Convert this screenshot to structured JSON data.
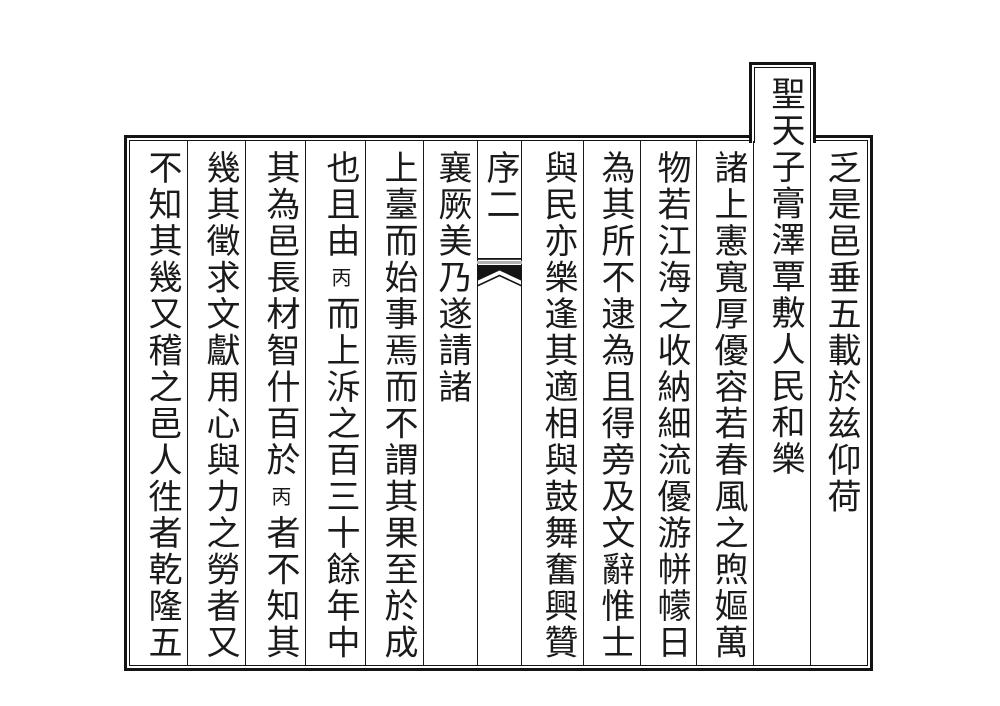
{
  "colors": {
    "ink": "#1a1a1a",
    "paper": "#ffffff",
    "ornament_gray": "#b0b0b0"
  },
  "reading_order": "columns right to left, characters top to bottom",
  "tab": {
    "label": "聖天子膏澤覃敷人民和樂"
  },
  "center_column": {
    "label": "序二",
    "ornament_icon": "fishtail-icon"
  },
  "columns": [
    {
      "text": "乏是邑垂五載於兹仰荷"
    },
    {
      "text": "聖天子膏澤覃敷人民和樂",
      "placement": "tab"
    },
    {
      "text": "諸上憲寬厚優容若春風之煦嫗萬"
    },
    {
      "text": "物若江海之收納細流優游帡幪日"
    },
    {
      "text": "為其所不逮為且得旁及文辭惟士"
    },
    {
      "text": "與民亦樂逢其適相與鼓舞奮興贊"
    },
    {
      "text": "序二",
      "placement": "center"
    },
    {
      "text": "襄厥美乃遂請諸"
    },
    {
      "text": "上臺而始事焉而不謂其果至於成"
    },
    {
      "segments": [
        "也且由",
        {
          "small": "丙"
        },
        "而上泝之百三十餘年中"
      ]
    },
    {
      "segments": [
        "其為邑長材智什百於",
        {
          "small": "丙"
        },
        "者不知其"
      ]
    },
    {
      "text": "幾其徵求文獻用心與力之勞者又"
    },
    {
      "text": "不知其幾又稽之邑人徃者乾隆五"
    }
  ]
}
